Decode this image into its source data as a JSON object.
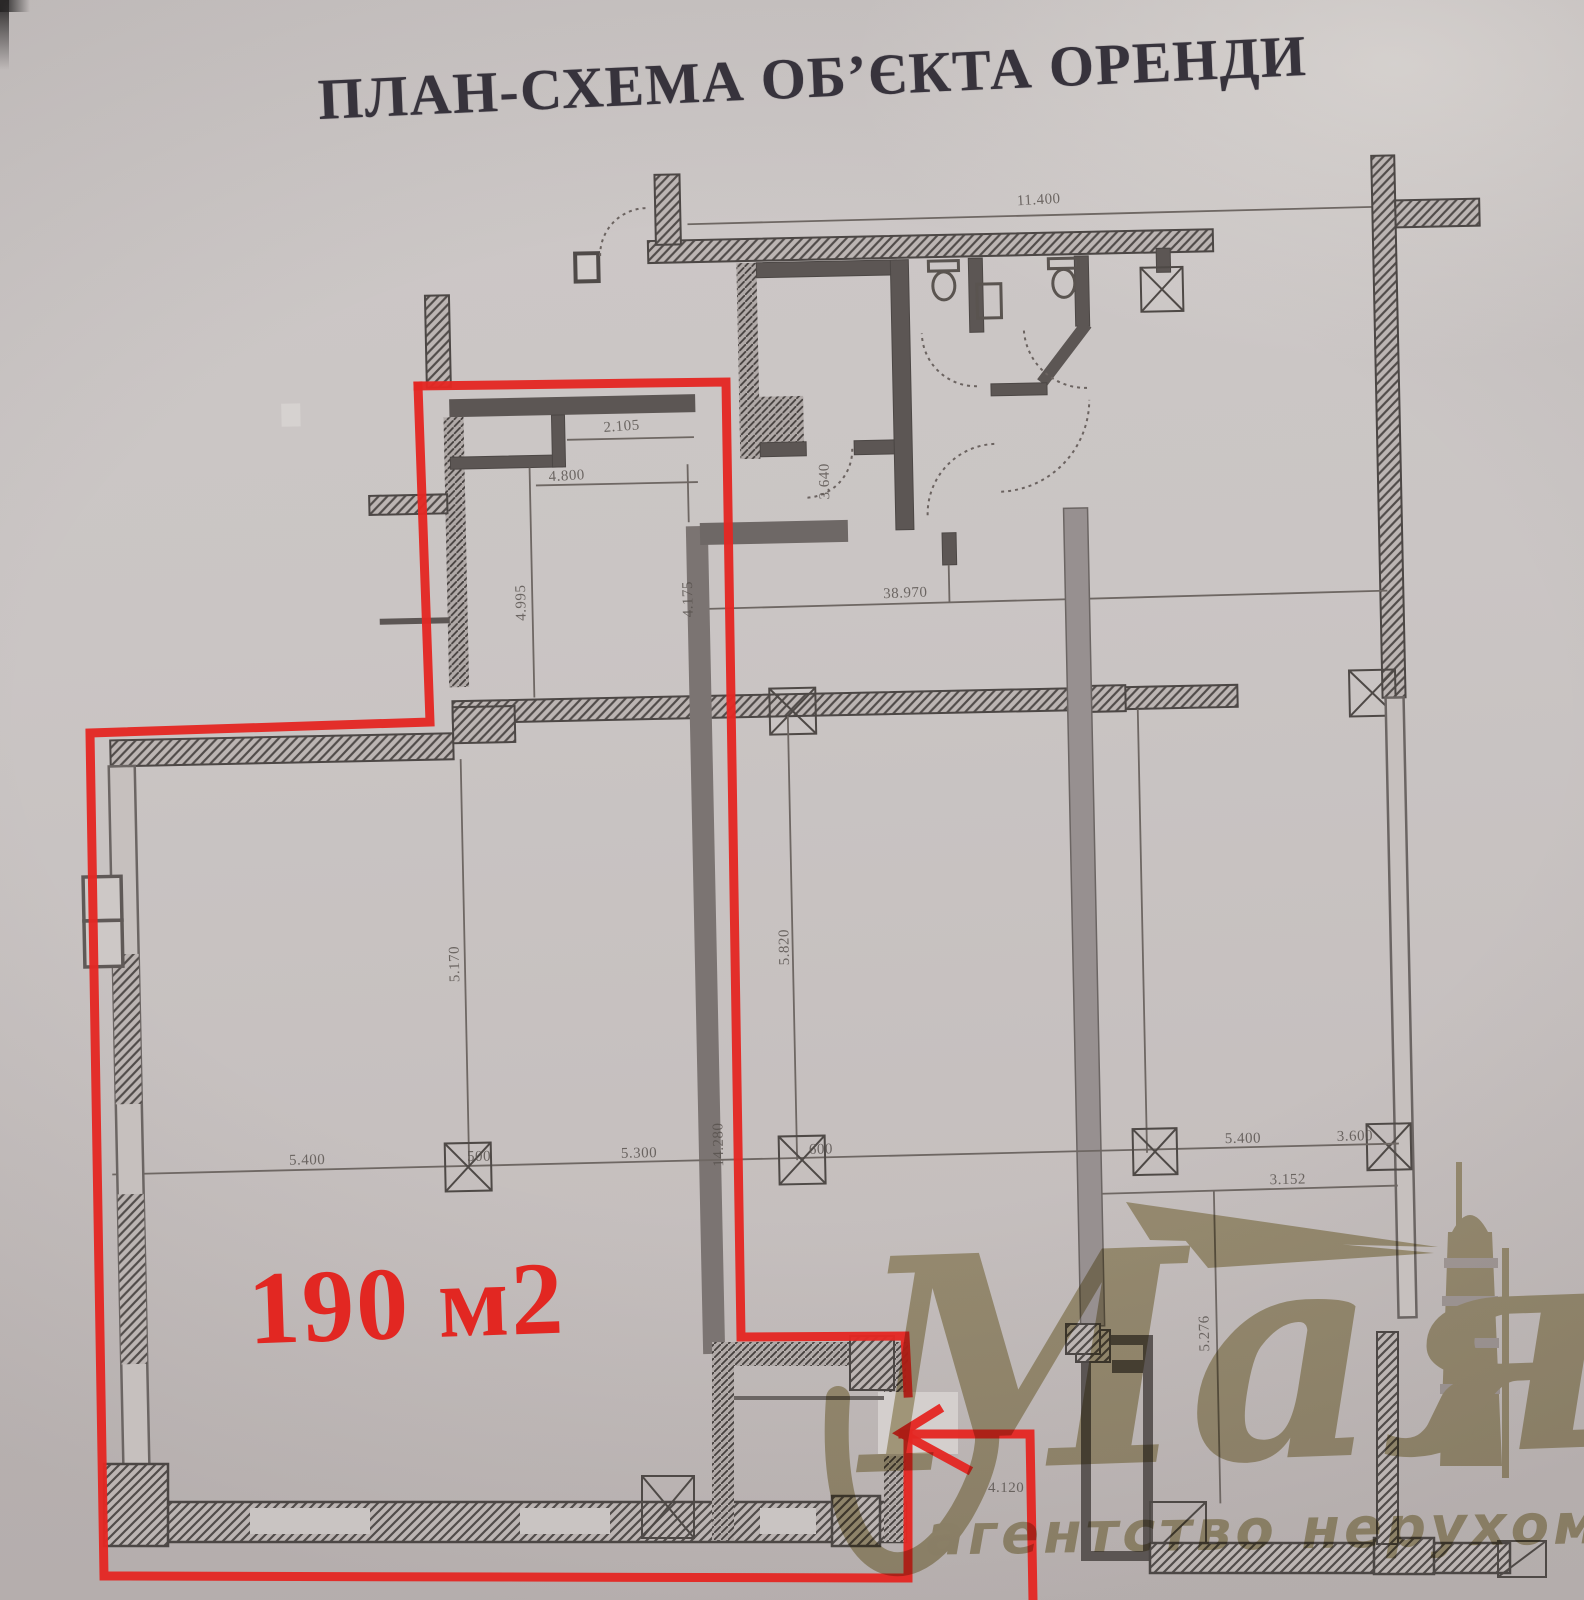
{
  "header": {
    "title": "ПЛАН-СХЕМА ОБ’ЄКТА ОРЕНДИ"
  },
  "overlay": {
    "area_label": "190 м2",
    "outline_color": "#e42823",
    "note": "red outline marks rented area with arrow to entrance"
  },
  "watermark": {
    "brand": "Маяк",
    "tagline": "агентство нерухомості",
    "color": "#b5ab81",
    "icon": "lighthouse-with-beams"
  },
  "plan": {
    "paper_color": "#cac5c3",
    "ink_color": "#4f4a49",
    "dims": [
      {
        "t": "11.400"
      },
      {
        "t": "2.105"
      },
      {
        "t": "4.800"
      },
      {
        "t": "3.640"
      },
      {
        "t": "38.970"
      },
      {
        "t": "4.995"
      },
      {
        "t": "4.175"
      },
      {
        "t": "5.170"
      },
      {
        "t": "14.280"
      },
      {
        "t": "5.820"
      },
      {
        "t": "5.400"
      },
      {
        "t": "500"
      },
      {
        "t": "5.300"
      },
      {
        "t": "600"
      },
      {
        "t": "5.400"
      },
      {
        "t": "3.600"
      },
      {
        "t": "3.152"
      },
      {
        "t": "5.276"
      },
      {
        "t": "4.120"
      }
    ]
  }
}
